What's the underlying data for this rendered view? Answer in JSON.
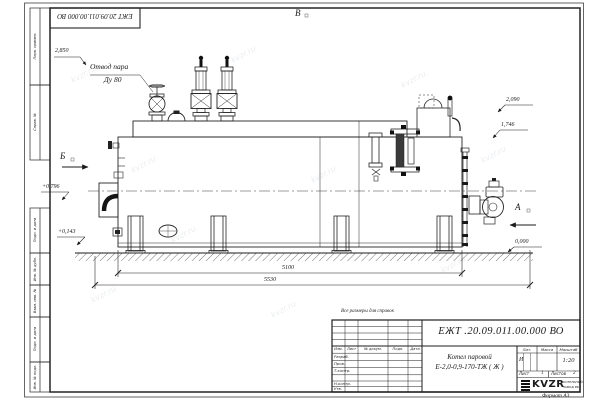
{
  "frame": {
    "top_stamp": "ЕЖТ 20.09.011.00.000  ВО",
    "format_label": "Формат А3",
    "reference_note": "Все размеры для справок",
    "side_columns_top": [
      "Перв. примен.",
      "Справ. №"
    ],
    "side_columns_bottom": [
      "Подп. и дата",
      "Инв. № дубл.",
      "Взам. инв. №",
      "Подп. и дата",
      "Инв. № подл."
    ]
  },
  "view_markers": {
    "a": "А",
    "b": "Б",
    "v": "В"
  },
  "annotations": {
    "steam_outlet_line1": "Отвод пара",
    "steam_outlet_line2": "Ду 80"
  },
  "elevations": [
    {
      "text": "2,850"
    },
    {
      "text": "2,090"
    },
    {
      "text": "1,746"
    },
    {
      "text": "+0,796"
    },
    {
      "text": "+0,143"
    },
    {
      "text": "0,000"
    }
  ],
  "dimensions": [
    {
      "text": "5100"
    },
    {
      "text": "5530"
    }
  ],
  "title_block": {
    "doc_number": "ЕЖТ .20.09.011.00.000  ВО",
    "product_name_line1": "Котел паровой",
    "product_name_line2": "Е-2,0-0,9-170-ТЖ ( Ж )",
    "header_cols": {
      "izm": "Изм.",
      "list": "Лист",
      "ndoc": "№ докум.",
      "podp": "Подп.",
      "data": "Дата"
    },
    "rows": [
      "Разраб.",
      "Пров.",
      "Т.контр.",
      "Н.контр.",
      "Утв."
    ],
    "lit_label": "Лит.",
    "mass_label": "Масса",
    "scale_label": "Масштаб",
    "lit_value": "И",
    "scale_value": "1:20",
    "sheet_label": "Лист",
    "sheet_value": "1",
    "sheets_label": "Листов",
    "sheets_value": "2",
    "company": "KVZR",
    "company_sub1": "КОТЕЛЬНЫЙ",
    "company_sub2": "ЗАВОД РФ"
  },
  "watermark": "kvzr.ru",
  "colors": {
    "line": "#252525",
    "paper": "#ffffff"
  }
}
